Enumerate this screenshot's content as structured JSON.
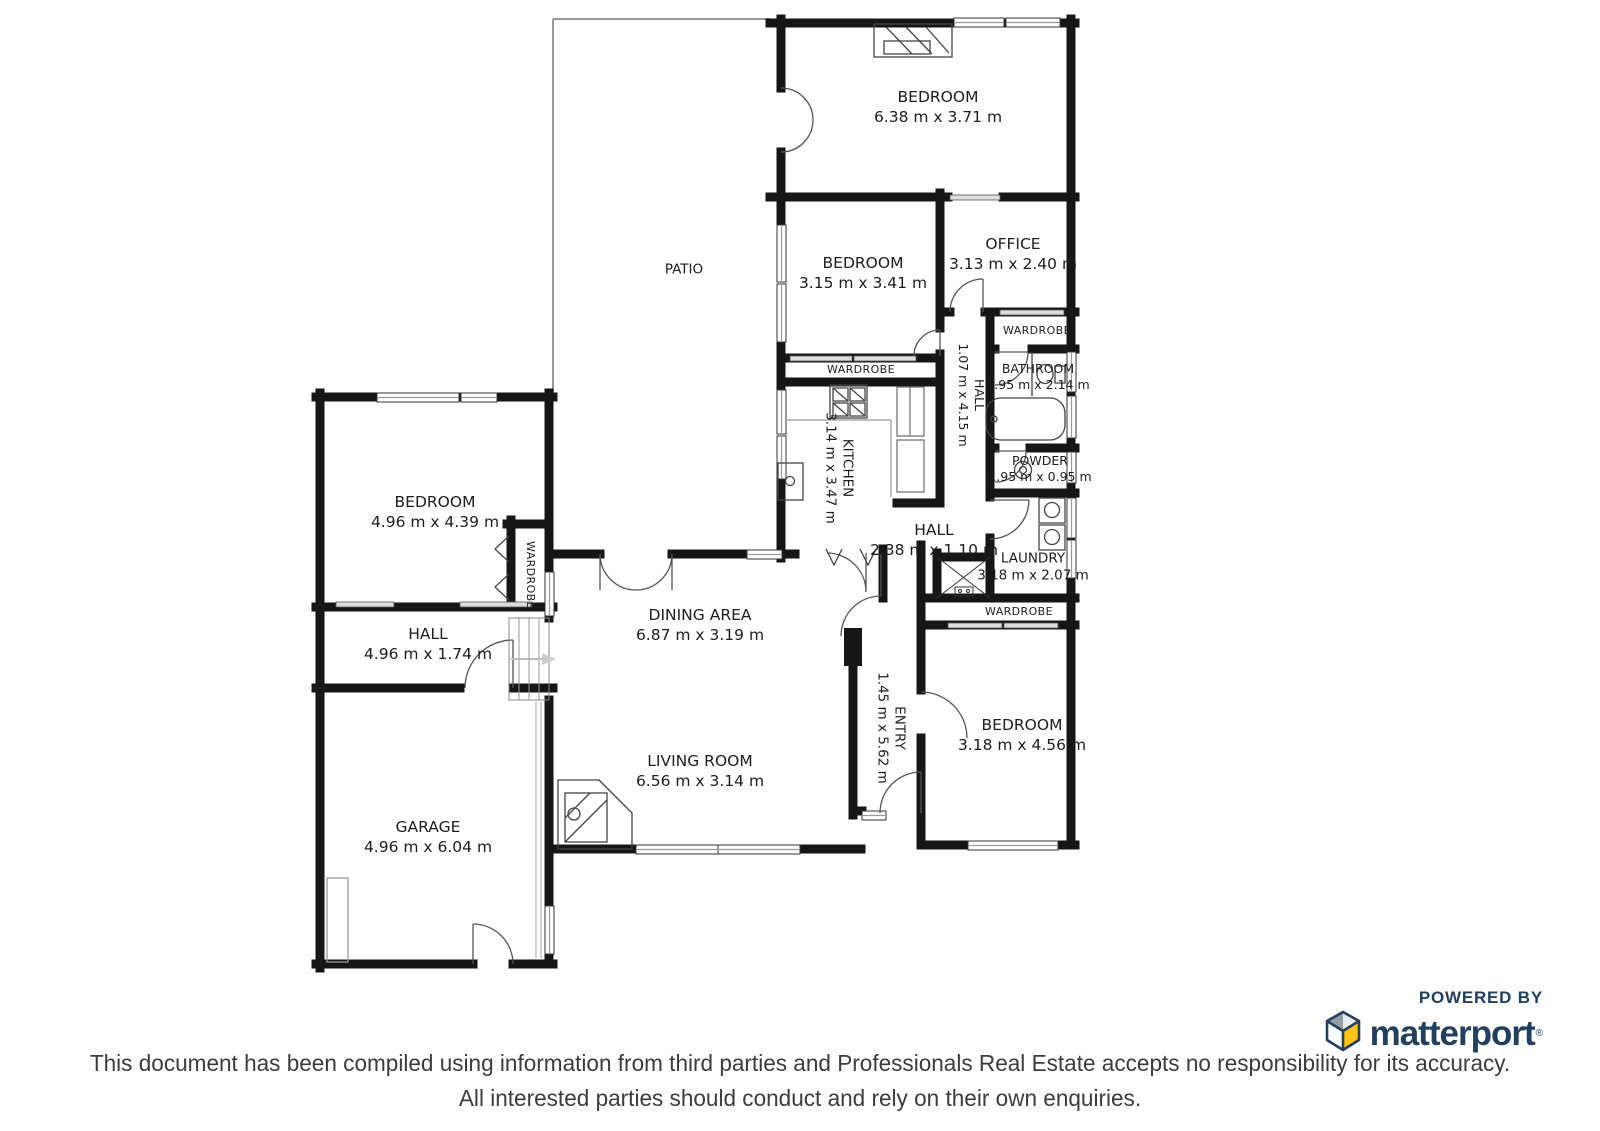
{
  "rooms": [
    {
      "name": "BEDROOM",
      "dims": "6.38 m x 3.71 m"
    },
    {
      "name": "PATIO",
      "dims": ""
    },
    {
      "name": "BEDROOM",
      "dims": "3.15 m x 3.41 m"
    },
    {
      "name": "OFFICE",
      "dims": "3.13 m x 2.40 m"
    },
    {
      "name": "WARDROBE",
      "dims": ""
    },
    {
      "name": "BATHROOM",
      "dims": "1.95 m x 2.14 m"
    },
    {
      "name": "HALL",
      "dims": "1.07 m x 4.15 m"
    },
    {
      "name": "POWDER",
      "dims": "1.95 m x 0.95 m"
    },
    {
      "name": "KITCHEN",
      "dims": "3.14 m x 3.47 m"
    },
    {
      "name": "WARDROBE",
      "dims": ""
    },
    {
      "name": "HALL",
      "dims": "2.38 m x 1.10 m"
    },
    {
      "name": "LAUNDRY",
      "dims": "3.18 m x 2.07 m"
    },
    {
      "name": "WARDROBE",
      "dims": ""
    },
    {
      "name": "BEDROOM",
      "dims": "4.96 m x 4.39 m"
    },
    {
      "name": "WARDROBE",
      "dims": ""
    },
    {
      "name": "HALL",
      "dims": "4.96 m x 1.74 m"
    },
    {
      "name": "DINING AREA",
      "dims": "6.87 m x 3.19 m"
    },
    {
      "name": "ENTRY",
      "dims": "1.45 m x 5.62 m"
    },
    {
      "name": "BEDROOM",
      "dims": "3.18 m x 4.56 m"
    },
    {
      "name": "LIVING ROOM",
      "dims": "6.56 m x 3.14 m"
    },
    {
      "name": "GARAGE",
      "dims": "4.96 m x 6.04 m"
    }
  ],
  "footer": {
    "disclaimer_line1": "This document has been compiled using information from third parties and Professionals Real Estate accepts no responsibility for its accuracy.",
    "disclaimer_line2": "All interested parties should conduct and rely on their own enquiries."
  },
  "branding": {
    "powered_by": "POWERED BY",
    "brand_name": "matterport",
    "registered_mark": "®",
    "brand_navy": "#22405e",
    "brand_yellow": "#fcc50f"
  }
}
